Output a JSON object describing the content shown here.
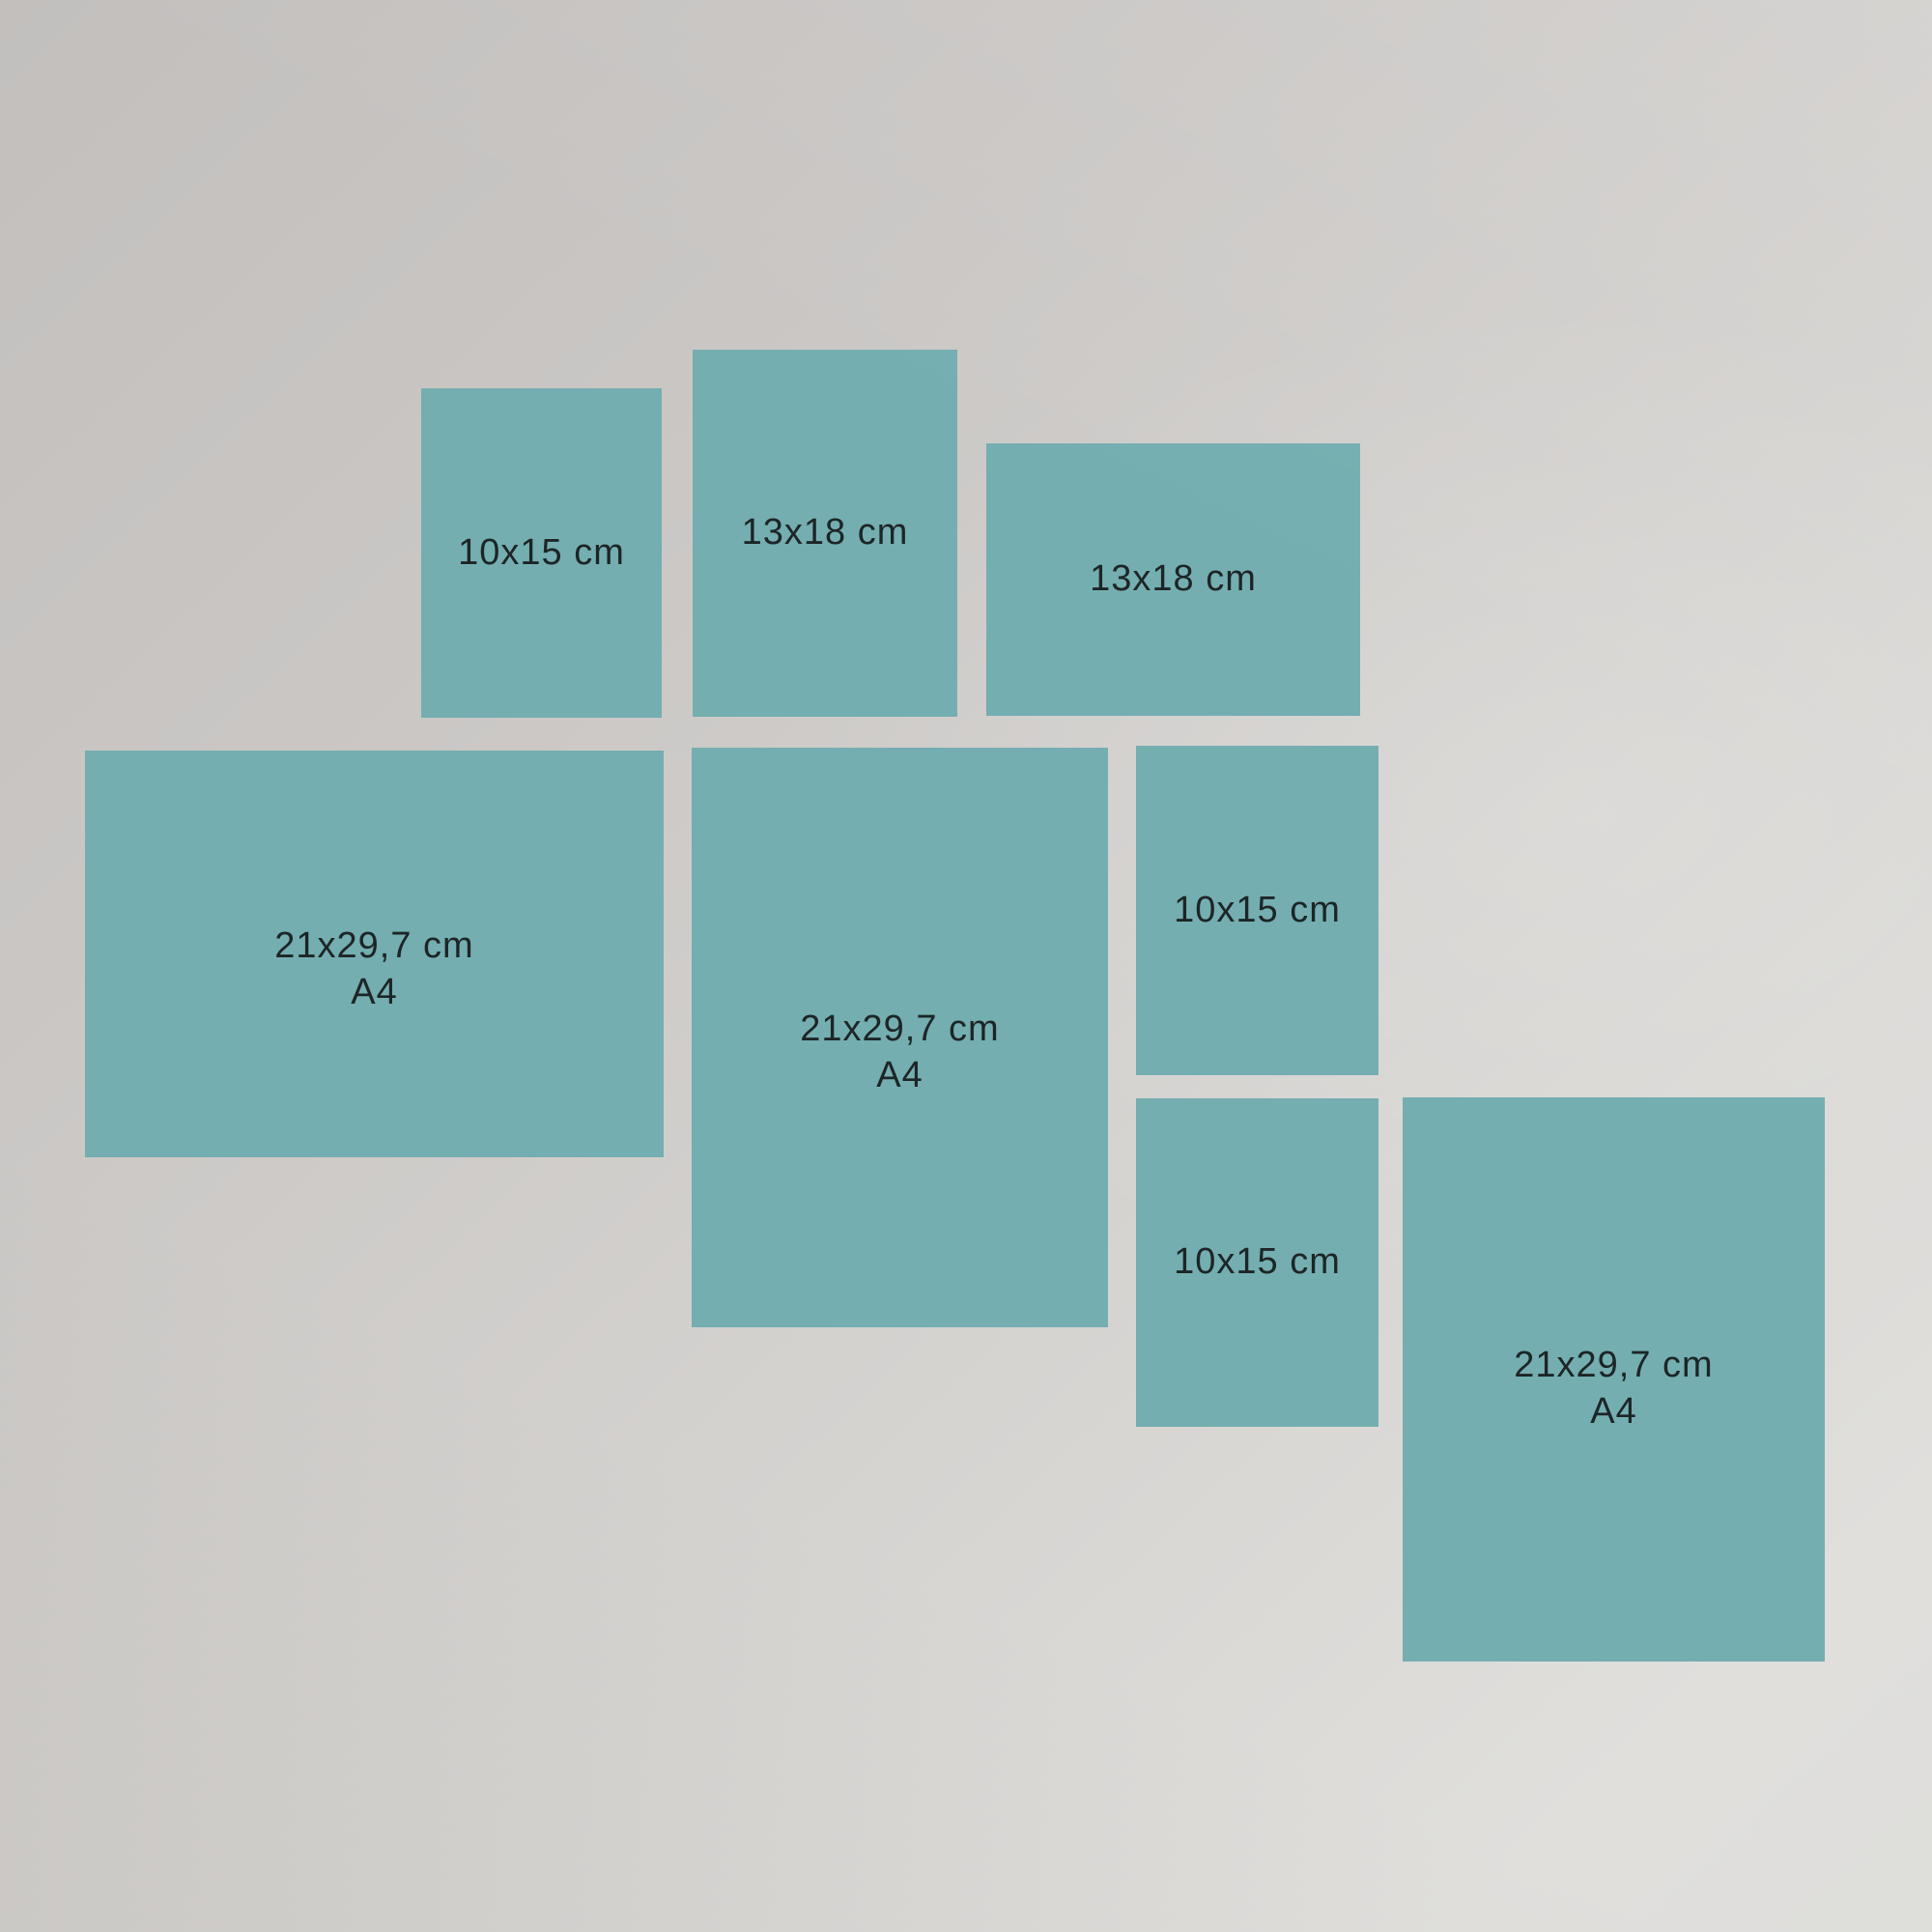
{
  "figure": {
    "type": "print-size-comparison",
    "accent_color": "#74aeb0",
    "text_color": "#1d2526",
    "background_from": "#c2bfbd",
    "background_to": "#e0dfdc"
  },
  "rects": [
    {
      "label": "10x15 cm",
      "sublabel": "",
      "orientation": "portrait"
    },
    {
      "label": "13x18 cm",
      "sublabel": "",
      "orientation": "portrait"
    },
    {
      "label": "13x18 cm",
      "sublabel": "",
      "orientation": "landscape"
    },
    {
      "label": "21x29,7 cm",
      "sublabel": "A4",
      "orientation": "landscape"
    },
    {
      "label": "21x29,7 cm",
      "sublabel": "A4",
      "orientation": "portrait"
    },
    {
      "label": "10x15 cm",
      "sublabel": "",
      "orientation": "portrait"
    },
    {
      "label": "10x15 cm",
      "sublabel": "",
      "orientation": "portrait"
    },
    {
      "label": "21x29,7 cm",
      "sublabel": "A4",
      "orientation": "portrait"
    }
  ]
}
